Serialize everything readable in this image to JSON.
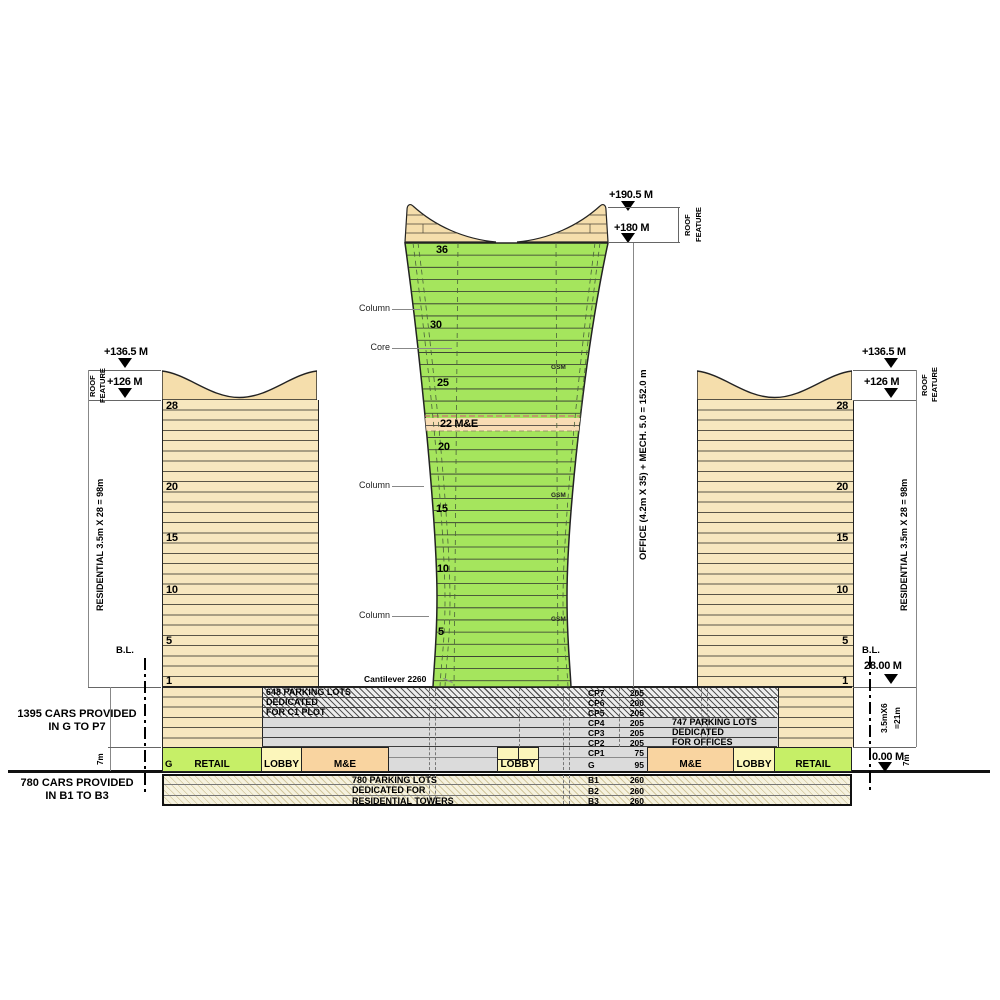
{
  "colors": {
    "residential_fill": "#F7E7BF",
    "roof_feature_fill": "#F5DEAC",
    "office_fill": "#A5E55D",
    "mech_band_fill": "#F8DCB4",
    "retail_fill": "#C6EF67",
    "lobby_fill": "#FCF6BB",
    "me_fill": "#F9D4A0",
    "podium_gray": "#DBDBDB"
  },
  "office_tower": {
    "elev_top": "+190.5 M",
    "elev_roof": "+180 M",
    "roof_feature": "ROOF\nFEATURE",
    "dim_note": "OFFICE (4.2m X 35) + MECH. 5.0 = 152.0 m",
    "floors": [
      "36",
      "30",
      "25",
      "22 M&E",
      "20",
      "15",
      "10",
      "5"
    ],
    "label_column": "Column",
    "label_core": "Core",
    "label_cantilever": "Cantilever 2260",
    "gsm": "GSM"
  },
  "left_tower": {
    "elev_top": "+136.5 M",
    "elev_roof": "+126 M",
    "roof_feature": "ROOF\nFEATURE",
    "dim_note": "RESIDENTIAL 3.5m X 28 = 98m",
    "floors": [
      "28",
      "20",
      "15",
      "10",
      "5",
      "1"
    ],
    "bl": "B.L.",
    "dim_7m": "7m"
  },
  "right_tower": {
    "elev_top": "+136.5 M",
    "elev_roof": "+126 M",
    "roof_feature": "ROOF\nFEATURE",
    "dim_note": "RESIDENTIAL 3.5m X 28 = 98m",
    "floors": [
      "28",
      "20",
      "15",
      "10",
      "5",
      "1"
    ],
    "bl": "B.L.",
    "bl_level": "28.00 M",
    "ground_level": "0.00 M",
    "dim_podium": "3.5mX6\n=21m",
    "dim_7m": "7m"
  },
  "podium": {
    "levels": [
      {
        "label": "CP7",
        "value": "205"
      },
      {
        "label": "CP6",
        "value": "200"
      },
      {
        "label": "CP5",
        "value": "205"
      },
      {
        "label": "CP4",
        "value": "205"
      },
      {
        "label": "CP3",
        "value": "205"
      },
      {
        "label": "CP2",
        "value": "205"
      },
      {
        "label": "CP1",
        "value": "75"
      },
      {
        "label": "G",
        "value": "95"
      }
    ],
    "basement_levels": [
      {
        "label": "B1",
        "value": "260"
      },
      {
        "label": "B2",
        "value": "260"
      },
      {
        "label": "B3",
        "value": "260"
      }
    ],
    "note_c1": "648 PARKING LOTS\nDEDICATED\nFOR C1 PLOT",
    "note_offices": "747 PARKING LOTS\nDEDICATED\nFOR OFFICES",
    "note_residential": "780 PARKING LOTS\nDEDICATED FOR\nRESIDENTIAL TOWERS",
    "ground": {
      "g": "G",
      "retail": "RETAIL",
      "lobby": "LOBBY",
      "me": "M&E"
    }
  },
  "side_notes": {
    "cars_podium": "1395 CARS PROVIDED\nIN G TO P7",
    "cars_basement": "780 CARS PROVIDED\nIN B1 TO B3"
  }
}
